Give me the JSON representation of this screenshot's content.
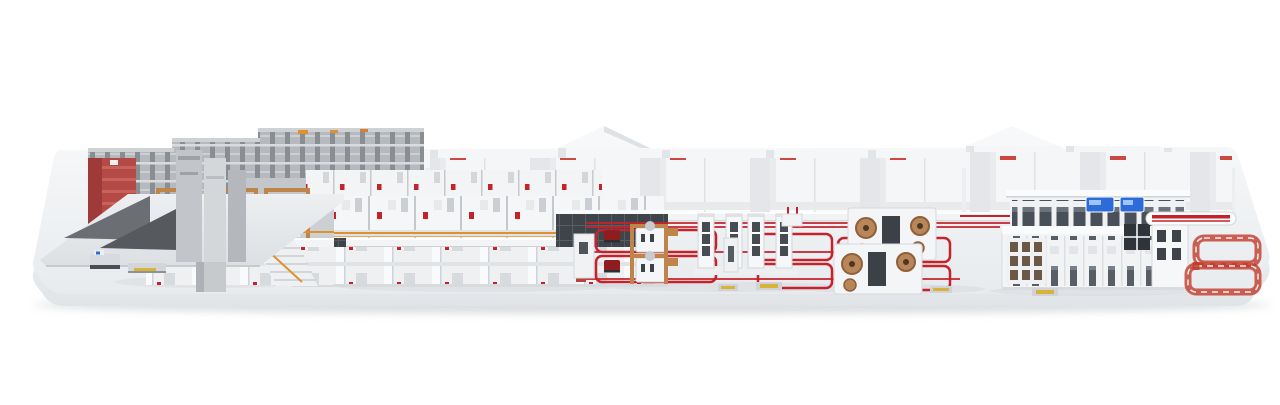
{
  "scene": {
    "type": "3d-render",
    "subject": "corrugated-board-production-line-on-white-platform",
    "background_color": "#ffffff"
  },
  "palette": {
    "accent_red": "#c5232b",
    "dark_red": "#8f1c1e",
    "wood_tan": "#bf8449",
    "roll_brown": "#9a6a42",
    "railing_orange": "#e0912f",
    "panel_dark": "#3f444b",
    "steel_gray": "#9aa0a6",
    "machine_white": "#f4f5f7",
    "platform_top": "#eef0f2",
    "screen_blue": "#2d6bd8",
    "pallet_yellow": "#d9b23a"
  },
  "components": [
    "reel-storage-racks",
    "red-service-tower",
    "infeed-deck",
    "agv",
    "pallet-truck",
    "splicer-stations",
    "paper-rolls",
    "mezzanine-bridge",
    "machine-modules",
    "dark-control-panels",
    "access-stairs",
    "floor-track-loops",
    "shuttle-vehicles",
    "robot-stations",
    "tower-stations",
    "reel-winding-stations",
    "background-halls",
    "cabinet-row",
    "glazed-corridor",
    "status-displays",
    "door-panel-wall",
    "striped-rail-conveyor",
    "red-loop-conveyor"
  ]
}
